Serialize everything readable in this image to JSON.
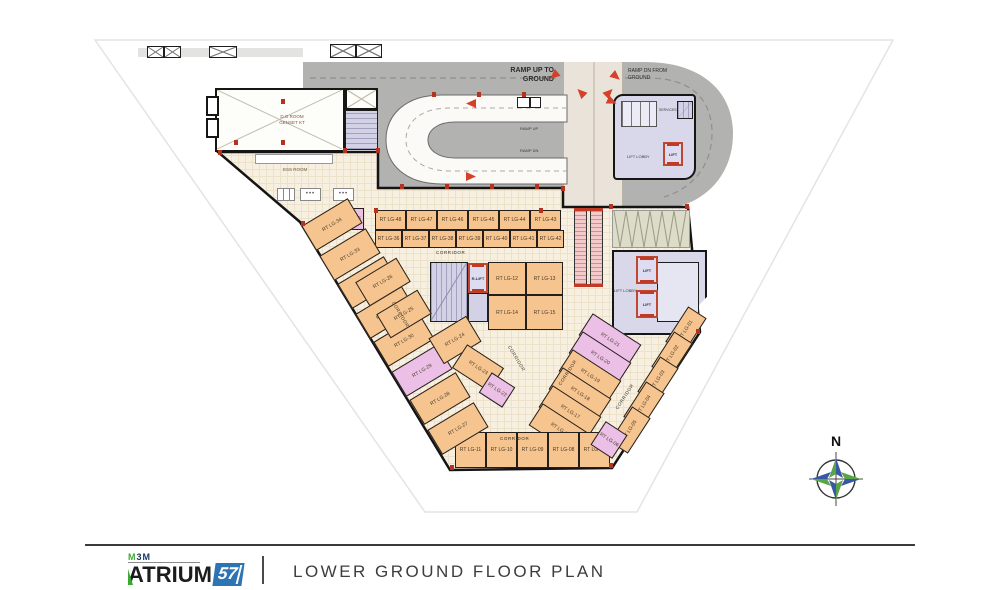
{
  "footer": {
    "brand_top": "M3M",
    "brand_main": "ATRIUM",
    "brand_num": "57",
    "title": "LOWER GROUND FLOOR PLAN"
  },
  "labels": {
    "corridor": "CORRIDOR",
    "ramp_up_1": "RAMP UP TO",
    "ramp_up_2": "GROUND",
    "ramp_dn_1": "RAMP DN FROM",
    "ramp_dn_2": "GROUND",
    "ramp_up_small": "RAMP UP",
    "ramp_dn_small": "RAMP DN",
    "dg_room_1": "D.G ROOM",
    "dg_room_2": "GENSET KT",
    "ess_room": "ESS ROOM",
    "lift": "LIFT",
    "r_lift": "R-LIFT",
    "lift_lobby": "LIFT LOBBY",
    "services": "SERVICES",
    "north": "N"
  },
  "colors": {
    "road_gray": "#b2b2b0",
    "plaza_cream": "#f7efdf",
    "shop_orange": "#f6c48e",
    "shop_pink": "#ecc0e6",
    "lobby_lavender": "#d9d7ea",
    "accent_red": "#c03a26",
    "brand_blue": "#2d74b5",
    "brand_green": "#3aaa35"
  },
  "shops": [
    {
      "label": "RT LG-48",
      "x": 375,
      "y": 210,
      "w": 31,
      "h": 20,
      "rot": 0
    },
    {
      "label": "RT LG-47",
      "x": 406,
      "y": 210,
      "w": 31,
      "h": 20,
      "rot": 0
    },
    {
      "label": "RT LG-46",
      "x": 437,
      "y": 210,
      "w": 31,
      "h": 20,
      "rot": 0
    },
    {
      "label": "RT LG-45",
      "x": 468,
      "y": 210,
      "w": 31,
      "h": 20,
      "rot": 0
    },
    {
      "label": "RT LG-44",
      "x": 499,
      "y": 210,
      "w": 31,
      "h": 20,
      "rot": 0
    },
    {
      "label": "RT LG-43",
      "x": 530,
      "y": 210,
      "w": 31,
      "h": 20,
      "rot": 0
    },
    {
      "label": "RT LG-36",
      "x": 375,
      "y": 230,
      "w": 27,
      "h": 18,
      "rot": 0
    },
    {
      "label": "RT LG-37",
      "x": 402,
      "y": 230,
      "w": 27,
      "h": 18,
      "rot": 0
    },
    {
      "label": "RT LG-38",
      "x": 429,
      "y": 230,
      "w": 27,
      "h": 18,
      "rot": 0
    },
    {
      "label": "RT LG-39",
      "x": 456,
      "y": 230,
      "w": 27,
      "h": 18,
      "rot": 0
    },
    {
      "label": "RT LG-40",
      "x": 483,
      "y": 230,
      "w": 27,
      "h": 18,
      "rot": 0
    },
    {
      "label": "RT LG-41",
      "x": 510,
      "y": 230,
      "w": 27,
      "h": 18,
      "rot": 0
    },
    {
      "label": "RT LG-42",
      "x": 537,
      "y": 230,
      "w": 27,
      "h": 18,
      "rot": 0
    },
    {
      "label": "RT LG-35",
      "x": 336,
      "y": 208,
      "w": 28,
      "h": 22,
      "rot": 0,
      "pink": true
    },
    {
      "label": "RT LG-12",
      "x": 488,
      "y": 262,
      "w": 38,
      "h": 33,
      "rot": 0
    },
    {
      "label": "RT LG-13",
      "x": 526,
      "y": 262,
      "w": 37,
      "h": 33,
      "rot": 0
    },
    {
      "label": "RT LG-14",
      "x": 488,
      "y": 295,
      "w": 38,
      "h": 35,
      "rot": 0
    },
    {
      "label": "RT LG-15",
      "x": 526,
      "y": 295,
      "w": 37,
      "h": 35,
      "rot": 0
    },
    {
      "label": "RT LG-21",
      "x": 581,
      "y": 327,
      "w": 58,
      "h": 26,
      "rot": 33,
      "pink": true
    },
    {
      "label": "RT LG-20",
      "x": 571,
      "y": 345,
      "w": 58,
      "h": 26,
      "rot": 33,
      "pink": true
    },
    {
      "label": "RT LG-19",
      "x": 561,
      "y": 363,
      "w": 58,
      "h": 26,
      "rot": 33
    },
    {
      "label": "RT LG-18",
      "x": 551,
      "y": 381,
      "w": 58,
      "h": 26,
      "rot": 33
    },
    {
      "label": "RT LG-17",
      "x": 541,
      "y": 399,
      "w": 58,
      "h": 26,
      "rot": 33
    },
    {
      "label": "RT LG-16",
      "x": 531,
      "y": 417,
      "w": 58,
      "h": 26,
      "rot": 33
    },
    {
      "label": "RT LG-01",
      "x": 665,
      "y": 319,
      "w": 42,
      "h": 22,
      "rot": -57
    },
    {
      "label": "RT LG-02",
      "x": 651,
      "y": 344,
      "w": 42,
      "h": 22,
      "rot": -57
    },
    {
      "label": "RT LG-03",
      "x": 637,
      "y": 369,
      "w": 42,
      "h": 22,
      "rot": -57
    },
    {
      "label": "RT LG-04",
      "x": 623,
      "y": 394,
      "w": 42,
      "h": 22,
      "rot": -57
    },
    {
      "label": "RT LG-05",
      "x": 609,
      "y": 419,
      "w": 42,
      "h": 22,
      "rot": -57
    },
    {
      "label": "RT LG-11",
      "x": 455,
      "y": 432,
      "w": 31,
      "h": 36,
      "rot": 0
    },
    {
      "label": "RT LG-10",
      "x": 486,
      "y": 432,
      "w": 31,
      "h": 36,
      "rot": 0
    },
    {
      "label": "RT LG-09",
      "x": 517,
      "y": 432,
      "w": 31,
      "h": 36,
      "rot": 0
    },
    {
      "label": "RT LG-08",
      "x": 548,
      "y": 432,
      "w": 31,
      "h": 36,
      "rot": 0
    },
    {
      "label": "RT LG-07",
      "x": 579,
      "y": 432,
      "w": 31,
      "h": 36,
      "rot": 0
    },
    {
      "label": "RT LG-06",
      "x": 596,
      "y": 426,
      "w": 26,
      "h": 28,
      "rot": 33,
      "pink": true
    },
    {
      "label": "RT LG-34",
      "x": 305,
      "y": 210,
      "w": 54,
      "h": 29,
      "rot": -31
    },
    {
      "label": "RT LG-33",
      "x": 323,
      "y": 240,
      "w": 54,
      "h": 29,
      "rot": -31
    },
    {
      "label": "RT LG-32",
      "x": 341,
      "y": 268,
      "w": 54,
      "h": 29,
      "rot": -31
    },
    {
      "label": "RT LG-31",
      "x": 359,
      "y": 298,
      "w": 54,
      "h": 29,
      "rot": -31
    },
    {
      "label": "RT LG-30",
      "x": 377,
      "y": 326,
      "w": 54,
      "h": 29,
      "rot": -31
    },
    {
      "label": "RT LG-29",
      "x": 395,
      "y": 356,
      "w": 54,
      "h": 29,
      "rot": -31,
      "pink": true
    },
    {
      "label": "RT LG-28",
      "x": 413,
      "y": 384,
      "w": 54,
      "h": 29,
      "rot": -31
    },
    {
      "label": "RT LG-27",
      "x": 431,
      "y": 414,
      "w": 54,
      "h": 29,
      "rot": -31
    },
    {
      "label": "RT LG-26",
      "x": 359,
      "y": 268,
      "w": 48,
      "h": 28,
      "rot": -31
    },
    {
      "label": "RT LG-25",
      "x": 380,
      "y": 300,
      "w": 48,
      "h": 28,
      "rot": -31
    },
    {
      "label": "RT LG-24",
      "x": 433,
      "y": 325,
      "w": 44,
      "h": 30,
      "rot": -31
    },
    {
      "label": "RT LG-23",
      "x": 456,
      "y": 354,
      "w": 44,
      "h": 28,
      "rot": 33
    },
    {
      "label": "RT LG-22",
      "x": 483,
      "y": 378,
      "w": 28,
      "h": 24,
      "rot": 33,
      "pink": true
    }
  ],
  "corridor_labels": [
    {
      "x": 436,
      "y": 250,
      "rot": 0
    },
    {
      "x": 500,
      "y": 436,
      "rot": 0
    },
    {
      "x": 386,
      "y": 312,
      "rot": 59
    },
    {
      "x": 502,
      "y": 356,
      "rot": 59
    },
    {
      "x": 553,
      "y": 370,
      "rot": -57
    },
    {
      "x": 610,
      "y": 394,
      "rot": -57
    }
  ],
  "wall_dots": [
    {
      "x": 432,
      "y": 92
    },
    {
      "x": 477,
      "y": 92
    },
    {
      "x": 522,
      "y": 92
    },
    {
      "x": 400,
      "y": 184
    },
    {
      "x": 445,
      "y": 184
    },
    {
      "x": 490,
      "y": 184
    },
    {
      "x": 535,
      "y": 184
    },
    {
      "x": 561,
      "y": 186
    },
    {
      "x": 609,
      "y": 204
    },
    {
      "x": 685,
      "y": 204
    },
    {
      "x": 696,
      "y": 329
    },
    {
      "x": 450,
      "y": 465
    },
    {
      "x": 609,
      "y": 463
    },
    {
      "x": 301,
      "y": 221
    },
    {
      "x": 218,
      "y": 150
    },
    {
      "x": 343,
      "y": 148
    },
    {
      "x": 376,
      "y": 148
    },
    {
      "x": 374,
      "y": 208
    },
    {
      "x": 539,
      "y": 208
    },
    {
      "x": 281,
      "y": 99
    },
    {
      "x": 281,
      "y": 140
    },
    {
      "x": 234,
      "y": 140
    }
  ],
  "arrows": [
    {
      "x": 549,
      "y": 71,
      "rot": 140
    },
    {
      "x": 611,
      "y": 72,
      "rot": 40
    },
    {
      "x": 576,
      "y": 88,
      "rot": -135
    },
    {
      "x": 604,
      "y": 88,
      "rot": -45
    },
    {
      "x": 607,
      "y": 97,
      "rot": 25
    },
    {
      "x": 466,
      "y": 99,
      "rot": 180
    },
    {
      "x": 466,
      "y": 172,
      "rot": 0
    }
  ],
  "vents": [
    {
      "x": 147,
      "y": 46,
      "w": 17,
      "h": 12
    },
    {
      "x": 164,
      "y": 46,
      "w": 17,
      "h": 12
    },
    {
      "x": 209,
      "y": 46,
      "w": 28,
      "h": 12
    },
    {
      "x": 330,
      "y": 44,
      "w": 26,
      "h": 14
    },
    {
      "x": 356,
      "y": 44,
      "w": 26,
      "h": 14
    }
  ]
}
